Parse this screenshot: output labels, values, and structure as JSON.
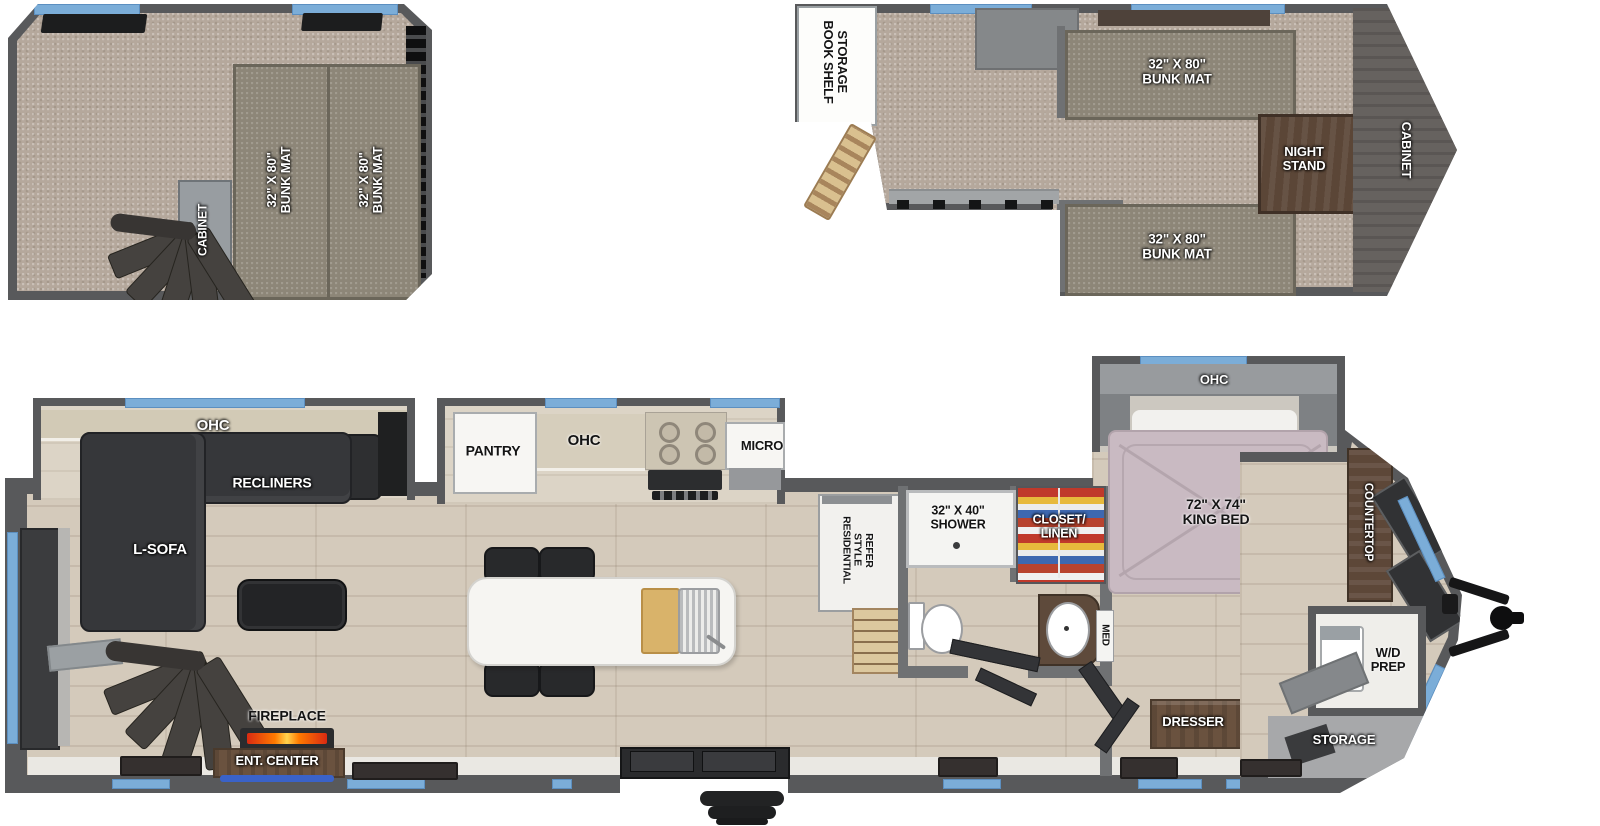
{
  "colors": {
    "wall": "#58595b",
    "window_glass": "#7badd8",
    "floor_wood": "#d4cabb",
    "carpet": "#b5a89c",
    "bunk_mat": "#8d8678",
    "accent_wood": "#6a523f",
    "fireplace_flame": "#ff7a00",
    "ent_center_led": "#3a62c8"
  },
  "rear_loft": {
    "bunk_mat_left": "32\" X 80\"\nBUNK MAT",
    "bunk_mat_right": "32\" X 80\"\nBUNK MAT",
    "cabinet": "CABINET"
  },
  "front_loft": {
    "book_shelf_storage": "BOOK SHELF\nSTORAGE",
    "bunk_mat_top": "32\" X 80\"\nBUNK MAT",
    "night_stand": "NIGHT\nSTAND",
    "bunk_mat_bottom": "32\" X 80\"\nBUNK MAT",
    "cabinet": "CABINET"
  },
  "main_floor": {
    "ohc_living": "OHC",
    "recliners": "RECLINERS",
    "l_sofa": "L-SOFA",
    "fireplace": "FIREPLACE",
    "ent_center": "ENT. CENTER",
    "pantry": "PANTRY",
    "ohc_kitchen": "OHC",
    "micro": "MICRO",
    "refer": "RESIDENTIAL\nSTYLE\nREFER",
    "shower": "32\" X 40\"\nSHOWER",
    "closet_linen": "CLOSET/\nLINEN",
    "med": "MED",
    "ohc_bedroom": "OHC",
    "king_bed": "72\" X 74\"\nKING BED",
    "countertop": "COUNTERTOP",
    "wd_prep": "W/D\nPREP",
    "dresser": "DRESSER",
    "storage": "STORAGE"
  }
}
